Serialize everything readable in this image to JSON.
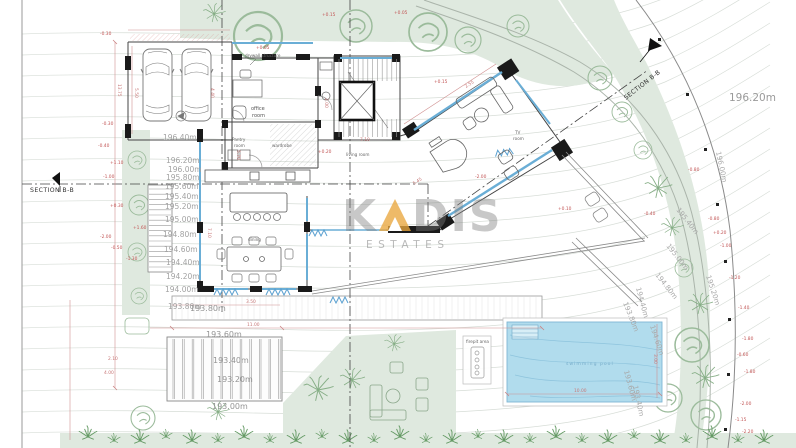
{
  "watermark": {
    "part1": "K",
    "part2": "DIS",
    "line2": "ESTATES"
  },
  "colors": {
    "accent_orange": "#e9a63d",
    "pool_blue": "#a9d8eb",
    "landscape_green": "#dfe9df",
    "dimension_red": "#c25555",
    "glazing_blue": "#6aaed6"
  },
  "section_labels": {
    "left": "SECTION B-B",
    "top_right": "SECTION B-B"
  },
  "room_labels": {
    "drywall": "drywall structure",
    "office_1": "office",
    "office_2": "room",
    "pantry_1": "Pantry",
    "pantry_2": "room",
    "wardrobe": "wardrobe",
    "living": "living room",
    "dining": "dining",
    "tv_1": "TV",
    "tv_2": "room",
    "pool": "swimming pool",
    "firepit": "firepit area"
  },
  "contour_labels_left": [
    "196.40m",
    "196.20m",
    "196.00m",
    "195.80m",
    "195.60m",
    "195.40m",
    "195.20m",
    "195.00m",
    "194.80m",
    "194.60m",
    "194.40m",
    "194.20m",
    "194.00m",
    "193.80m"
  ],
  "contour_labels_deck": [
    "193.80m",
    "193.60m",
    "193.40m",
    "193.20m",
    "193.00m"
  ],
  "contour_labels_right": [
    "196.20m",
    "196.00m",
    "195.40m",
    "195.00m",
    "194.80m",
    "195.20m",
    "194.40m",
    "193.80m",
    "194.60m",
    "193.60m",
    "193.40m"
  ],
  "spot_elevations": [
    "+0.15",
    "+0.05",
    "+0.05",
    "+0.15",
    "+0.20",
    "-2.00",
    "+0.10",
    "-0.30",
    "-0.30",
    "-0.40",
    "+1.10",
    "-1.00",
    "+0.30",
    "-2.00",
    "-0.50",
    "-1.30",
    "+1.60",
    "-0.80",
    "-0.40",
    "-0.80",
    "+0.20",
    "-1.00",
    "-1.20",
    "-1.40",
    "-1.80",
    "-0.60",
    "-1.80",
    "-2.00",
    "-1.15",
    "-2.20"
  ],
  "dimensions": [
    "13.75",
    "5.50",
    "4.40",
    "5.70",
    "2.00",
    "7.10",
    "7.10",
    "2.55",
    "5.45",
    "3.50",
    "11.00",
    "10.00",
    "3.00",
    "2.10",
    "4.00"
  ]
}
